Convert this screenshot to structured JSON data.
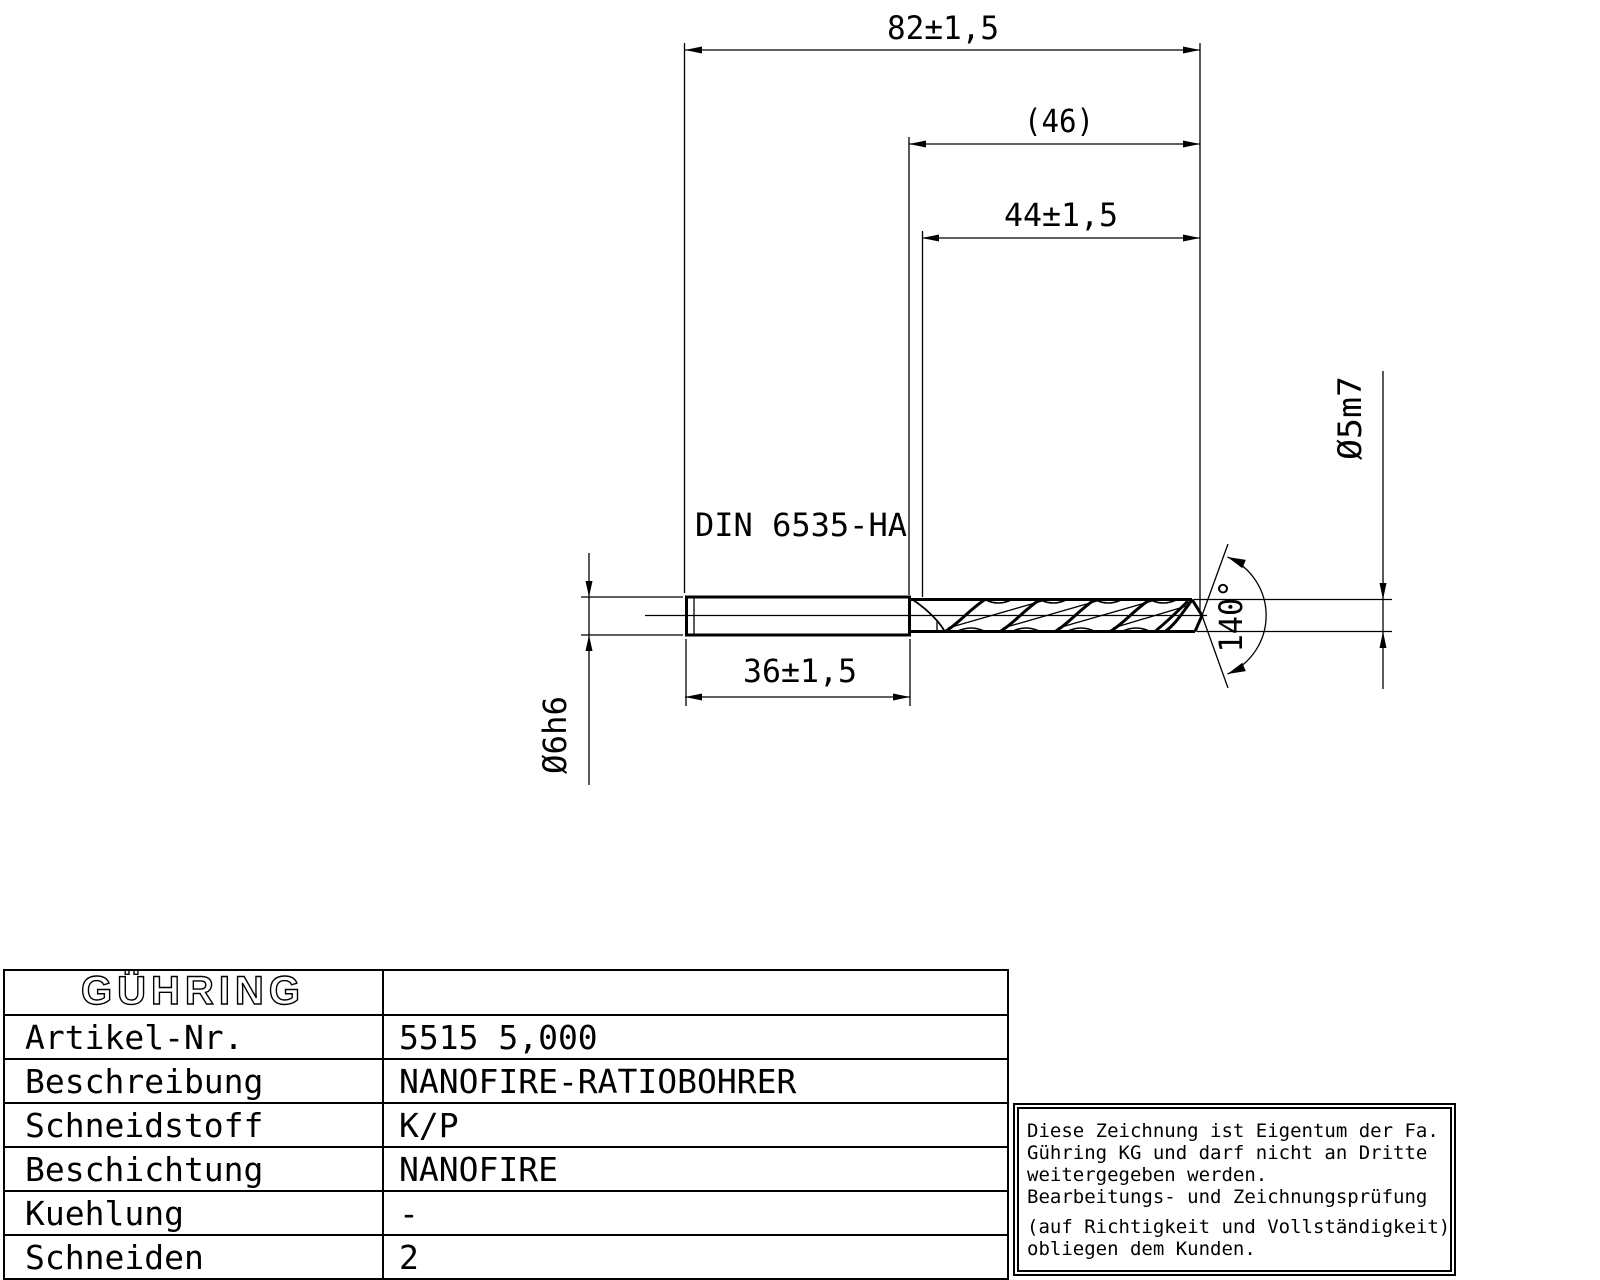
{
  "drawing": {
    "dim_overall_length": "82±1,5",
    "dim_flute_ref": "(46)",
    "dim_flute_length": "44±1,5",
    "dim_shank_length": "36±1,5",
    "label_shank_standard": "DIN 6535-HA",
    "dim_shank_diameter": "Ø6h6",
    "dim_drill_diameter": "Ø5m7",
    "dim_point_angle": "140°"
  },
  "infobox": {
    "brand": "GÜHRING",
    "rows": [
      {
        "label": "Artikel-Nr.",
        "value": "5515 5,000"
      },
      {
        "label": "Beschreibung",
        "value": "NANOFIRE-RATIOBOHRER"
      },
      {
        "label": "Schneidstoff",
        "value": "K/P"
      },
      {
        "label": "Beschichtung",
        "value": "NANOFIRE"
      },
      {
        "label": "Kuehlung",
        "value": "-"
      },
      {
        "label": "Schneiden",
        "value": "2"
      }
    ]
  },
  "note": {
    "lines": [
      "Diese Zeichnung ist Eigentum der Fa.",
      "Gühring KG und darf nicht an Dritte",
      "weitergegeben werden.",
      "Bearbeitungs- und Zeichnungsprüfung",
      "(auf Richtigkeit und Vollständigkeit)",
      "obliegen dem Kunden."
    ]
  },
  "colors": {
    "ink": "#000000",
    "paper": "#ffffff"
  }
}
